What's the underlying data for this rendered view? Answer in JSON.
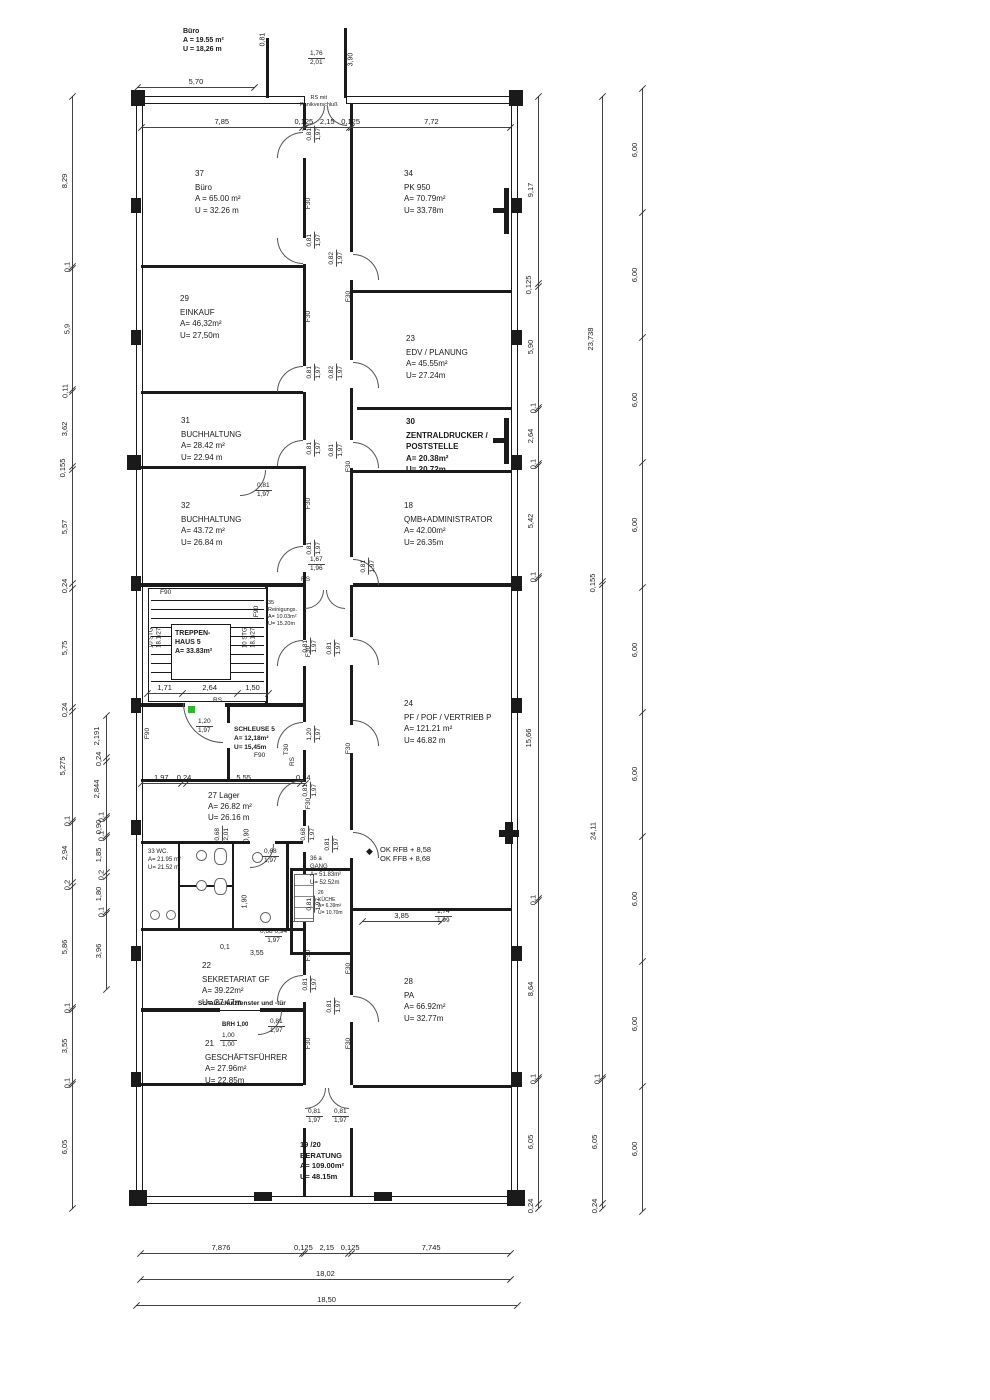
{
  "drawing": {
    "type": "architectural floor plan",
    "line_color": "#1a1a1a",
    "accent_green": "#33b633",
    "top_info": {
      "l1": "Büro",
      "l2": "A = 19.55 m²",
      "l3": "U = 18,26 m"
    },
    "entrance_note": {
      "l1": "RS mit",
      "l2": "Panikverschluß"
    },
    "level_note": {
      "l1": "OK RFB + 8,58",
      "l2": "OK FFB + 8,68",
      "marker": "diamond-icon"
    },
    "sound_note": "Schallschutzfenster und -tür",
    "brh_note": "BRH 1,00",
    "stair_steps": {
      "l1": "10 STG",
      "l2": "18.1/27"
    }
  },
  "labels": {
    "f30": "F30",
    "f90": "F90",
    "rs": "RS",
    "t30": "T30"
  },
  "rooms": [
    {
      "num": "37",
      "name": "Büro",
      "a": "A = 65.00 m²",
      "u": "U = 32.26 m"
    },
    {
      "num": "34",
      "name": "PK  950",
      "a": "A=  70.79m²",
      "u": "U=  33.78m"
    },
    {
      "num": "29",
      "name": "EINKAUF",
      "a": "A= 46,32m²",
      "u": "U= 27,50m"
    },
    {
      "num": "23",
      "name": "EDV / PLANUNG",
      "a": "A=  45.55m²",
      "u": "U=  27.24m"
    },
    {
      "num": "31",
      "name": "BUCHHALTUNG",
      "a": "A= 28.42 m²",
      "u": "U= 22.94 m"
    },
    {
      "num": "30",
      "name": "ZENTRALDRUCKER /",
      "name2": "POSTSTELLE",
      "a": "A=  20.38m²",
      "u": "U=  20.72m"
    },
    {
      "num": "32",
      "name": "BUCHHALTUNG",
      "a": "A= 43.72 m²",
      "u": "U= 26.84 m"
    },
    {
      "num": "18",
      "name": "QMB+ADMINISTRATOR",
      "a": "A=  42.00m²",
      "u": "U=  26.35m"
    },
    {
      "num": "",
      "name": "TREPPEN-",
      "name2": "HAUS 5",
      "a": "A= 33.83m²",
      "u": ""
    },
    {
      "num": "35",
      "name": "Reinigungs.",
      "a": "A=  10.03m²",
      "u": "U=  15.20m"
    },
    {
      "num": "",
      "name": "SCHLEUSE 5",
      "a": "A=  12,18m²",
      "u": "U=  15,45m"
    },
    {
      "num": "24",
      "name": "PF / POF / VERTRIEB P",
      "a": "A=  121.21 m²",
      "u": "U=    46.82 m"
    },
    {
      "num": "",
      "name": "27  Lager",
      "a": "A=  26.82 m²",
      "u": "U=  26.16 m"
    },
    {
      "num": "",
      "name": "33  WC.",
      "a": "A=  21.95 m²",
      "u": "U=  21.52 m"
    },
    {
      "num": "36 a",
      "name": "GANG",
      "a": "A=  51.83m²",
      "u": "U=  52.52m"
    },
    {
      "num": "26",
      "name": "KÜCHE",
      "a": "A=   6.39m²",
      "u": "U=  10.70m"
    },
    {
      "num": "22",
      "name": "SEKRETARIAT GF",
      "a": "A= 39.22m²",
      "u": "U= 27.47m"
    },
    {
      "num": "28",
      "name": "PA",
      "a": "A=  66.92m²",
      "u": "U=  32.77m"
    },
    {
      "num": "21",
      "name": "GESCHÄFTSFÜHRER",
      "a": "A= 27.96m²",
      "u": "U= 22.85m"
    },
    {
      "num": "19 /20",
      "name": "BERATUNG",
      "a": "A= 109.00m²",
      "u": "U=   48.15m"
    }
  ],
  "chains": {
    "left_outer": [
      "8,29",
      "0,1",
      "5,9",
      "0,11",
      "3,62",
      "0,155",
      "5,57",
      "0,24",
      "5,75",
      "0,24",
      "5,275",
      "0,1",
      "2,94",
      "0,2",
      "5,86",
      "0,1",
      "3,55",
      "0,1",
      "6,05"
    ],
    "left_inner": [
      "2,191",
      "0,24",
      "2,844",
      "0,1",
      "0,90",
      "0,1",
      "1,85",
      "0,2",
      "1,80",
      "0,1",
      "3,96"
    ],
    "right_inner": [
      "9,17",
      "0,125",
      "5,90",
      "0,1",
      "2,64",
      "0,1",
      "5,42",
      "0,1",
      "15,66",
      "0,1",
      "8,64",
      "0,1",
      "6,05",
      "0,24"
    ],
    "right_mid": [
      "23,738",
      "0,155",
      "24,11",
      "0,1",
      "6,05",
      "0,24"
    ],
    "right_outer": [
      "6,00",
      "6,00",
      "6,00",
      "6,00",
      "6,00",
      "6,00",
      "6,00",
      "6,00",
      "6,00"
    ],
    "top": [
      "7,85",
      "0,125",
      "2,15",
      "0,125",
      "7,72"
    ],
    "top570": [
      "5,70"
    ],
    "stair": [
      "1,71",
      "2,64",
      "1,50"
    ],
    "lager": [
      "1,97",
      "0,24",
      "5,55",
      "0,24"
    ],
    "r28": [
      "3,85"
    ],
    "bottom1": [
      "7,876",
      "0,125",
      "2,15",
      "0,125",
      "7,745"
    ],
    "bottom2": [
      "18,02"
    ],
    "bottom3": [
      "18,50"
    ]
  },
  "fracs": [
    {
      "w": "0,81",
      "h": "1,97"
    },
    {
      "w": "1,76",
      "h": "2,01"
    },
    {
      "w": "0,81",
      "h": "1,97"
    },
    {
      "w": "0,82",
      "h": "1,97"
    },
    {
      "w": "0,81",
      "h": "1,97"
    },
    {
      "w": "0,82",
      "h": "1,97"
    },
    {
      "w": "0,81",
      "h": "1,97"
    },
    {
      "w": "0,81",
      "h": "1,97"
    },
    {
      "w": "0,81",
      "h": "1,97"
    },
    {
      "w": "0,81",
      "h": "1,97"
    },
    {
      "w": "0,81",
      "h": "1,97"
    },
    {
      "w": "0,81",
      "h": "1,97"
    },
    {
      "w": "0,81",
      "h": "1,97"
    },
    {
      "w": "1,20",
      "h": "1,97"
    },
    {
      "w": "1,20",
      "h": "1,97"
    },
    {
      "w": "0,81",
      "h": "1,97"
    },
    {
      "w": "0,68",
      "h": "2,01"
    },
    {
      "w": "0,68",
      "h": "1,97"
    },
    {
      "w": "0,81",
      "h": "1,97"
    },
    {
      "w": "0,68",
      "h": "1,97"
    },
    {
      "w": "0,81",
      "h": "1,97"
    },
    {
      "w": "0,81",
      "h": "1,97"
    },
    {
      "w": "0,81",
      "h": "1,97"
    },
    {
      "w": "0,81",
      "h": "1,97"
    },
    {
      "w": "0,81",
      "h": "1,97"
    },
    {
      "w": "0,81",
      "h": "1,97"
    },
    {
      "w": "1,74",
      "h": "1,99"
    },
    {
      "w": "1,67",
      "h": "1,96"
    },
    {
      "w": "1,00",
      "h": "1,00"
    },
    {
      "w": "0,68  0,94",
      "h": "1,97"
    }
  ],
  "singles": [
    "0,81",
    "3,90",
    "0,90",
    "1,90",
    "3,85",
    "0,1",
    "3,55"
  ]
}
